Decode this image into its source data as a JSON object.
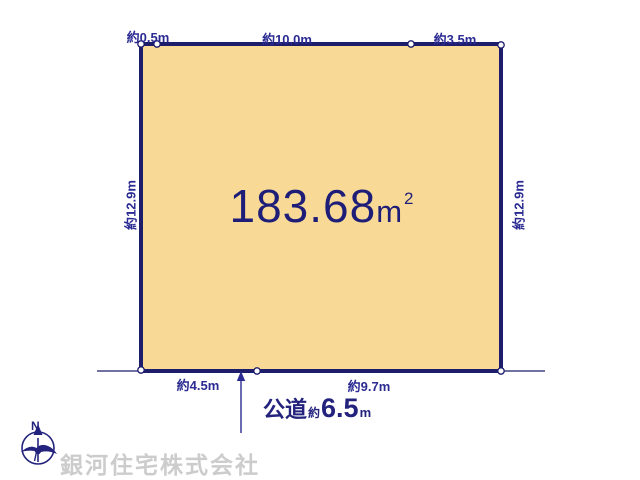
{
  "diagram": {
    "area": {
      "value": "183.68",
      "unit": "m",
      "sup": "2"
    },
    "dimensions": {
      "top_left": "約0.5m",
      "top_center": "約10.0m",
      "top_right": "約3.5m",
      "left": "約12.9m",
      "right": "約12.9m",
      "bottom_left": "約4.5m",
      "bottom_right": "約9.7m"
    },
    "road": {
      "name": "公道",
      "approx": "約",
      "value": "6.5",
      "unit": "m"
    },
    "compass": {
      "north": "N"
    },
    "watermark": "銀河住宅株式会社",
    "colors": {
      "plot_fill": "#f8da96",
      "plot_border": "#1d1d6b",
      "dimension_text": "#2b2b93",
      "area_text": "#1e1e78",
      "watermark_gray": "#c7c7c7"
    }
  }
}
